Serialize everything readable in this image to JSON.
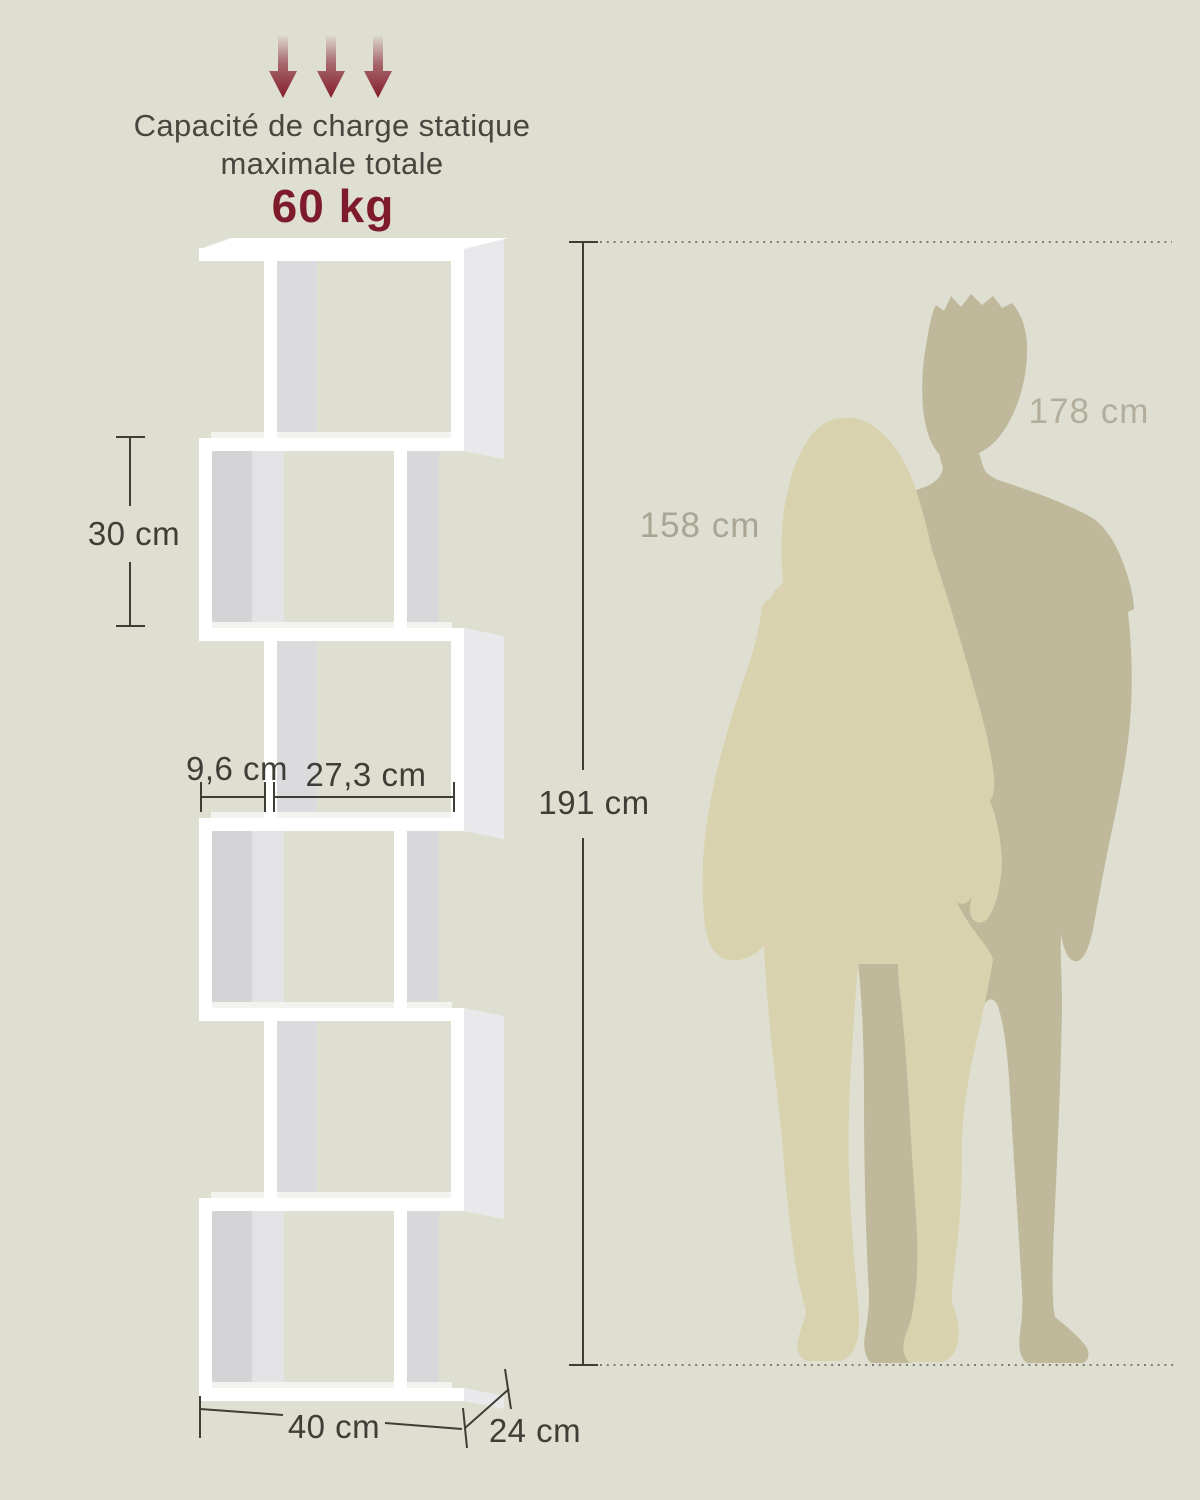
{
  "image": {
    "width": 1200,
    "height": 1500
  },
  "load_capacity": {
    "caption_line1": "Capacité de charge statique",
    "caption_line2": "maximale totale",
    "value": "60 kg",
    "arrow_icon": "down-arrow-icon",
    "arrow_count": 3
  },
  "dimensions": {
    "compartment_height": "30 cm",
    "side_offset": "9,6 cm",
    "compartment_width": "27,3 cm",
    "total_height": "191 cm",
    "total_width": "40 cm",
    "depth": "24 cm"
  },
  "size_reference": {
    "woman_height": "158 cm",
    "man_height": "178 cm"
  },
  "colors": {
    "background": "#DFDFD1",
    "accent_red": "#7E1B2A",
    "arrow_red": "#841D2C",
    "caption_ink": "#474740",
    "dimension_ink": "#3E3E37",
    "shelf_white": "#FFFFFF",
    "shelf_inner_gray": "#D4D4D6",
    "shelf_inner_gray_light": "#E3E3E5",
    "shelf_divider_gray": "#DBDBDD",
    "shelf_side_gray": "#E9E9EB",
    "shelf_floor_gray": "#F2F2EE",
    "woman_silhouette": "#D9D2AE",
    "man_silhouette": "#BFB89B",
    "woman_label": "#A9A592",
    "man_label": "#B3AE9B"
  }
}
